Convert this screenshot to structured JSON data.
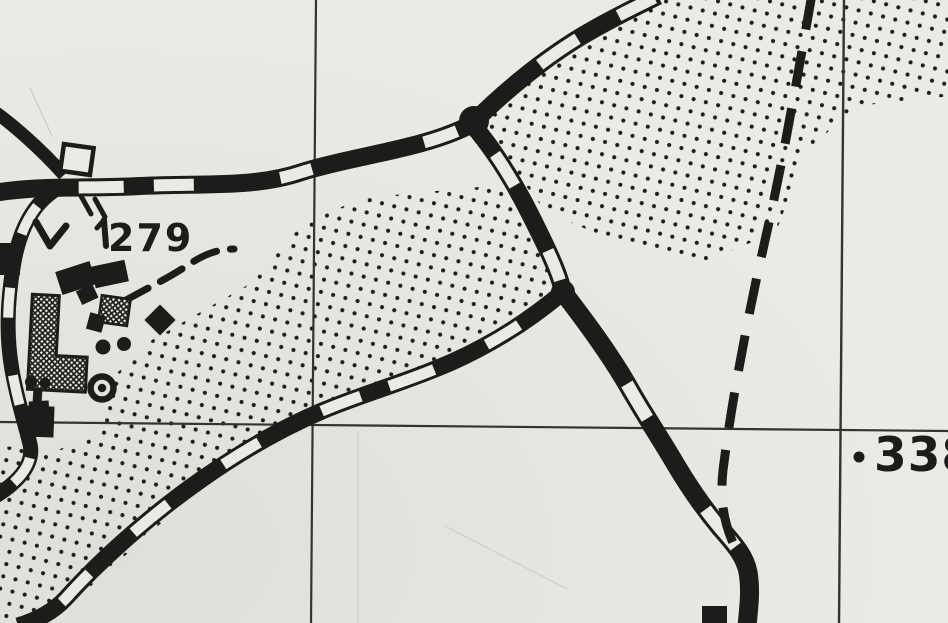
{
  "map": {
    "type": "scanned monochrome topographic map section",
    "paper_color": "#ebeae6",
    "ink_color": "#1d1c1a",
    "grid_color": "#35332f",
    "labels": {
      "spot_height_279": "279",
      "spot_height_338": "338"
    },
    "symbols": {
      "major_road": "double-line road with alternating black and white banding",
      "track": "bold dashed line",
      "footpath": "short dashed line",
      "grid": "thin black map grid lines",
      "vegetation_stipple": "black dot stipple area",
      "building": "solid black block",
      "hatched_building": "cross-hatched block",
      "well": "circle with central dot",
      "hollow_building": "open square outline"
    }
  }
}
